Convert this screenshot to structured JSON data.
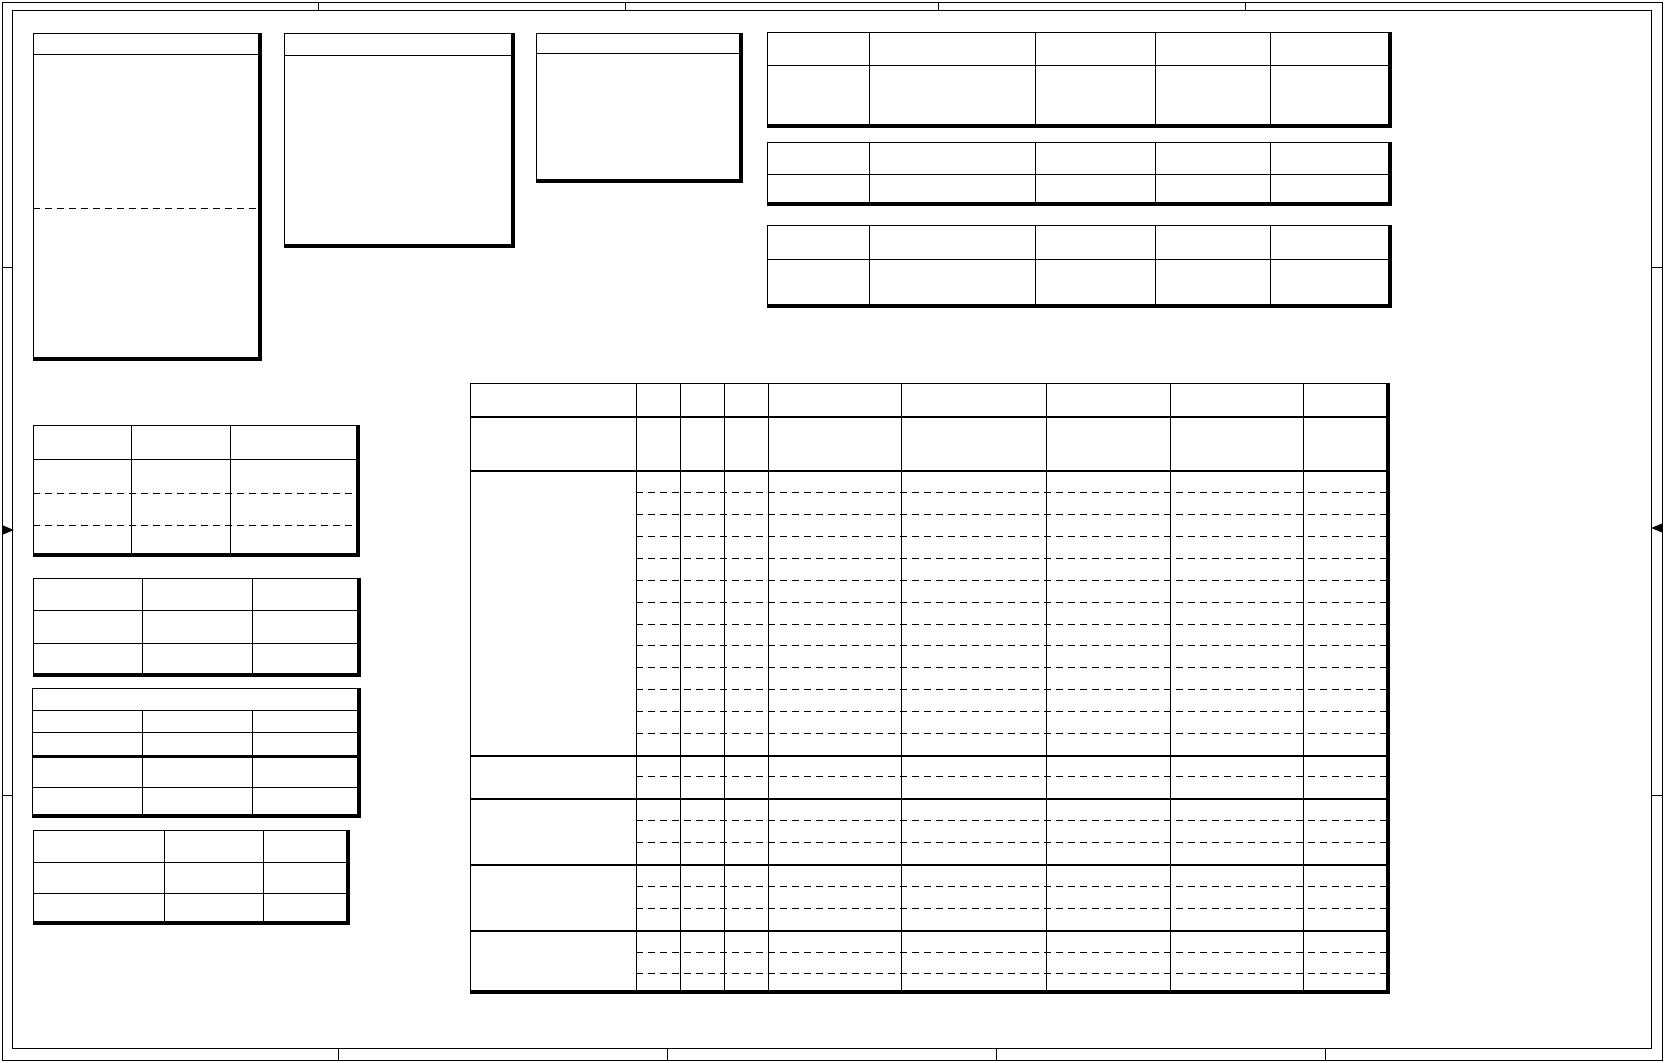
{
  "page": {
    "width": 1665,
    "height": 1063,
    "background": "#ffffff",
    "line_color": "#000000",
    "content_note": "blank drawing sheet - all table cells are empty, no visible text"
  },
  "frame": {
    "outer": {
      "x": 2,
      "y": 2,
      "x2": 1663,
      "y2": 1061
    },
    "inner": {
      "x": 12,
      "y": 10,
      "x2": 1652,
      "y2": 1049
    },
    "top_tick_x": [
      318,
      625,
      938,
      1245
    ],
    "bottom_tick_x": [
      338,
      667,
      996,
      1325
    ],
    "left_tick_y": [
      267,
      795
    ],
    "right_tick_y": [
      267,
      795
    ],
    "center_arrow_left_y": 525,
    "center_arrow_right_y": 523
  },
  "note_boxes": [
    {
      "name": "note-box-1",
      "x": 33,
      "y": 33,
      "x2": 262,
      "y2": 361,
      "header_line_y": 54,
      "dashed_line_y": [
        208
      ]
    },
    {
      "name": "note-box-2",
      "x": 284,
      "y": 33,
      "x2": 515,
      "y2": 248,
      "header_line_y": 55,
      "dashed_line_y": []
    },
    {
      "name": "note-box-3",
      "x": 536,
      "y": 33,
      "x2": 743,
      "y2": 183,
      "header_line_y": 53,
      "dashed_line_y": []
    }
  ],
  "header_tables": [
    {
      "name": "header-table-1",
      "x": 767,
      "y": 32,
      "x2": 1392,
      "y2": 128,
      "col_x": [
        869,
        1035,
        1155,
        1270
      ],
      "row_lines": [
        {
          "y": 65,
          "style": "solid"
        }
      ]
    },
    {
      "name": "header-table-2",
      "x": 767,
      "y": 142,
      "x2": 1392,
      "y2": 206,
      "col_x": [
        869,
        1035,
        1155,
        1270
      ],
      "row_lines": [
        {
          "y": 174,
          "style": "solid"
        }
      ]
    },
    {
      "name": "header-table-3",
      "x": 767,
      "y": 225,
      "x2": 1392,
      "y2": 308,
      "col_x": [
        869,
        1035,
        1155,
        1270
      ],
      "row_lines": [
        {
          "y": 259,
          "style": "solid"
        }
      ]
    }
  ],
  "side_tables": [
    {
      "name": "side-table-1",
      "x": 33,
      "y": 425,
      "x2": 360,
      "y2": 557,
      "col_x": [
        131,
        230
      ],
      "row_lines": [
        {
          "y": 459,
          "style": "solid"
        },
        {
          "y": 493,
          "style": "dashed"
        },
        {
          "y": 525,
          "style": "dashed"
        }
      ]
    },
    {
      "name": "side-table-2",
      "x": 33,
      "y": 578,
      "x2": 361,
      "y2": 677,
      "col_x": [
        142,
        252
      ],
      "row_lines": [
        {
          "y": 610,
          "style": "solid"
        },
        {
          "y": 643,
          "style": "solid"
        }
      ]
    },
    {
      "name": "side-table-3",
      "x": 32,
      "y": 688,
      "x2": 361,
      "y2": 818,
      "col_x": [
        142,
        252
      ],
      "col_start_y": 710,
      "row_lines": [
        {
          "y": 710,
          "style": "solid"
        },
        {
          "y": 732,
          "style": "solid"
        },
        {
          "y": 755,
          "style": "heavy"
        },
        {
          "y": 787,
          "style": "solid"
        }
      ]
    },
    {
      "name": "side-table-4",
      "x": 33,
      "y": 830,
      "x2": 350,
      "y2": 925,
      "col_x": [
        164,
        263
      ],
      "row_lines": [
        {
          "y": 862,
          "style": "solid"
        },
        {
          "y": 893,
          "style": "solid"
        }
      ]
    }
  ],
  "main_table": {
    "name": "main-schedule-table",
    "x": 470,
    "y": 383,
    "x2": 1390,
    "y2": 994,
    "label_col_x2": 636,
    "col_x": [
      636,
      680,
      724,
      768,
      901,
      1046,
      1170,
      1303
    ],
    "header_line_y": 416,
    "section_line_y": [
      470,
      755,
      798,
      864,
      930
    ],
    "dashed_row_y": [
      492,
      514,
      536,
      558,
      580,
      602,
      624,
      645,
      667,
      689,
      711,
      733,
      776,
      820,
      842,
      886,
      908,
      952,
      973
    ]
  }
}
